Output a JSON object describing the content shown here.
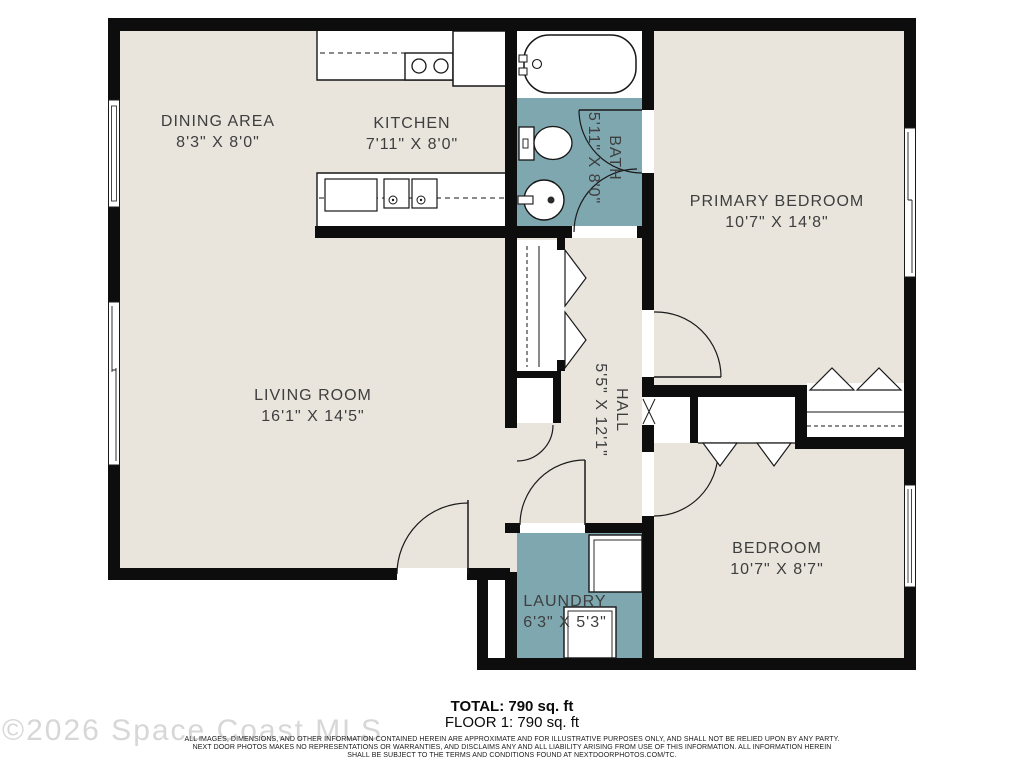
{
  "floor_plan": {
    "watermark": "©2026 Space Coast MLS",
    "summary": {
      "total": "TOTAL: 790 sq. ft",
      "floor": "FLOOR 1: 790 sq. ft"
    },
    "disclaimer_lines": [
      "ALL IMAGES, DIMENSIONS, AND OTHER INFORMATION CONTAINED HEREIN ARE APPROXIMATE AND FOR ILLUSTRATIVE PURPOSES ONLY, AND SHALL NOT BE RELIED UPON BY ANY PARTY.",
      "NEXT DOOR PHOTOS MAKES NO REPRESENTATIONS OR WARRANTIES, AND DISCLAIMS ANY AND ALL LIABILITY ARISING FROM USE OF THIS INFORMATION. ALL INFORMATION HEREIN",
      "SHALL BE SUBJECT TO THE TERMS AND CONDITIONS FOUND AT NEXTDOORPHOTOS.COM/TC."
    ],
    "colors": {
      "wall": "#0d0d0d",
      "floor": "#e9e5dd",
      "wet_room": "#7fa7af",
      "fixture": "#ffffff",
      "label": "#3e3e3e",
      "watermark": "#d7d7d7"
    },
    "rooms": [
      {
        "id": "dining",
        "name": "DINING AREA",
        "dims": "8'3\" X 8'0\""
      },
      {
        "id": "kitchen",
        "name": "KITCHEN",
        "dims": "7'11\" X 8'0\""
      },
      {
        "id": "bath",
        "name": "BATH",
        "dims": "5'11\" X 8'0\""
      },
      {
        "id": "primary",
        "name": "PRIMARY BEDROOM",
        "dims": "10'7\" X 14'8\""
      },
      {
        "id": "living",
        "name": "LIVING ROOM",
        "dims": "16'1\" X 14'5\""
      },
      {
        "id": "hall",
        "name": "HALL",
        "dims": "5'5\" X 12'1\""
      },
      {
        "id": "bedroom",
        "name": "BEDROOM",
        "dims": "10'7\" X 8'7\""
      },
      {
        "id": "laundry",
        "name": "LAUNDRY",
        "dims": "6'3\" X 5'3\""
      }
    ]
  }
}
